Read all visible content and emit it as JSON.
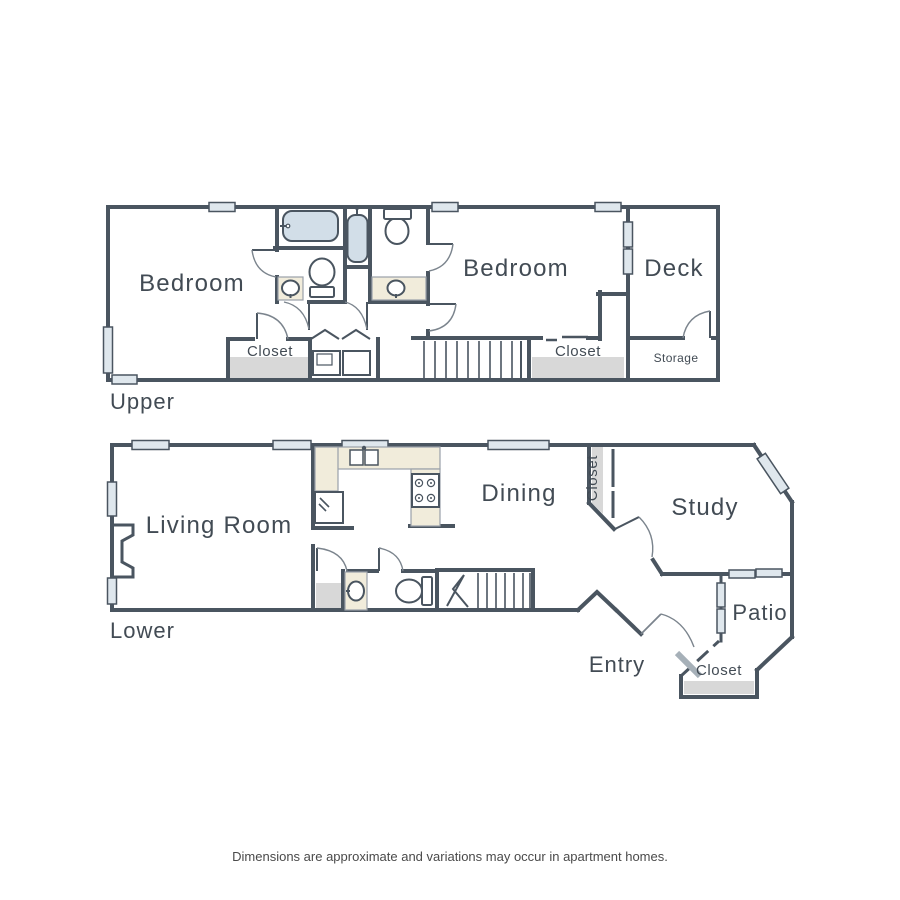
{
  "colors": {
    "bg": "#ffffff",
    "wall": "#4a5560",
    "window": "#dfe7ed",
    "fixture": "#d2dee8",
    "counter": "#f1ecdb",
    "closet_floor": "#d8d8d8",
    "label": "#424b54",
    "arc": "#7b848d",
    "door_leaf": "#a6b0b8",
    "disclaimer": "#4a4a4a"
  },
  "upper": {
    "floor_label": "Upper",
    "rooms": {
      "bedroom_left": "Bedroom",
      "bedroom_right": "Bedroom",
      "deck": "Deck",
      "closet_left": "Closet",
      "closet_right": "Closet",
      "storage": "Storage"
    }
  },
  "lower": {
    "floor_label": "Lower",
    "rooms": {
      "living_room": "Living Room",
      "dining": "Dining",
      "study": "Study",
      "patio": "Patio",
      "entry": "Entry",
      "closet_dining": "Closet",
      "closet_entry": "Closet"
    }
  },
  "footer": {
    "disclaimer": "Dimensions are approximate and variations may occur in apartment homes."
  }
}
